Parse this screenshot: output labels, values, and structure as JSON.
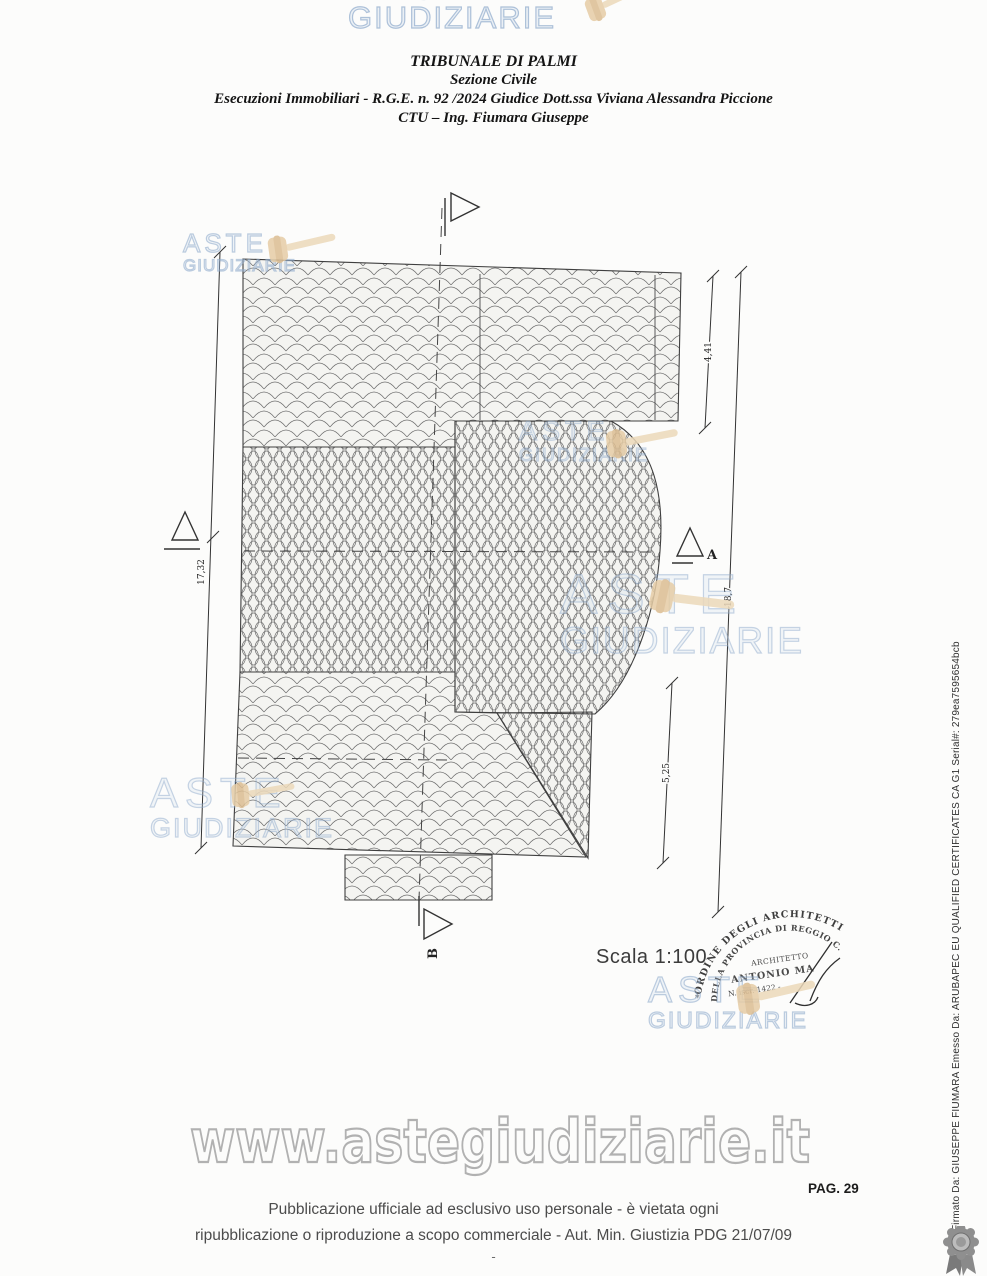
{
  "document": {
    "court_header": {
      "line1": "TRIBUNALE DI PALMI",
      "line2": "Sezione Civile",
      "line3": "Esecuzioni Immobiliari - R.G.E. n. 92 /2024 Giudice Dott.ssa Viviana Alessandra Piccione",
      "line4": "CTU – Ing. Fiumara Giuseppe"
    },
    "logo": {
      "word1": "ASTE",
      "word2": "GIUDIZIARIE"
    },
    "drawing": {
      "scale_label": "Scala 1:100",
      "dim_left": "17,32",
      "dim_right_top": "4,41",
      "dim_right_long": "18,7",
      "dim_right_bottom": "5,25",
      "marker_a": "A",
      "marker_b": "B"
    },
    "stamp": {
      "star": "*",
      "arc_top": "ORDINE DEGLI ARCHITETTI",
      "arc_bottom": "DELLA PROVINCIA DI REGGIO C.",
      "center1": "ARCHITETTO",
      "center2": "ANTONIO MA",
      "center3": "N. iscr. 1422 -"
    },
    "url_watermark": "www.astegiudiziarie.it",
    "page_label": "PAG. 29",
    "footer": {
      "line1": "Pubblicazione ufficiale ad esclusivo uso personale - è vietata ogni",
      "line2": "ripubblicazione o riproduzione a scopo commerciale - Aut. Min. Giustizia PDG 21/07/09",
      "dash": "-"
    },
    "signature_margin": "Firmato Da: GIUSEPPE FIUMARA Emesso Da: ARUBAPEC EU QUALIFIED CERTIFICATES CA G1 Serial#: 279ea7595654bcb",
    "colors": {
      "watermark_blue": "#a9bed9",
      "gavel_tan": "#e6cda6"
    }
  }
}
